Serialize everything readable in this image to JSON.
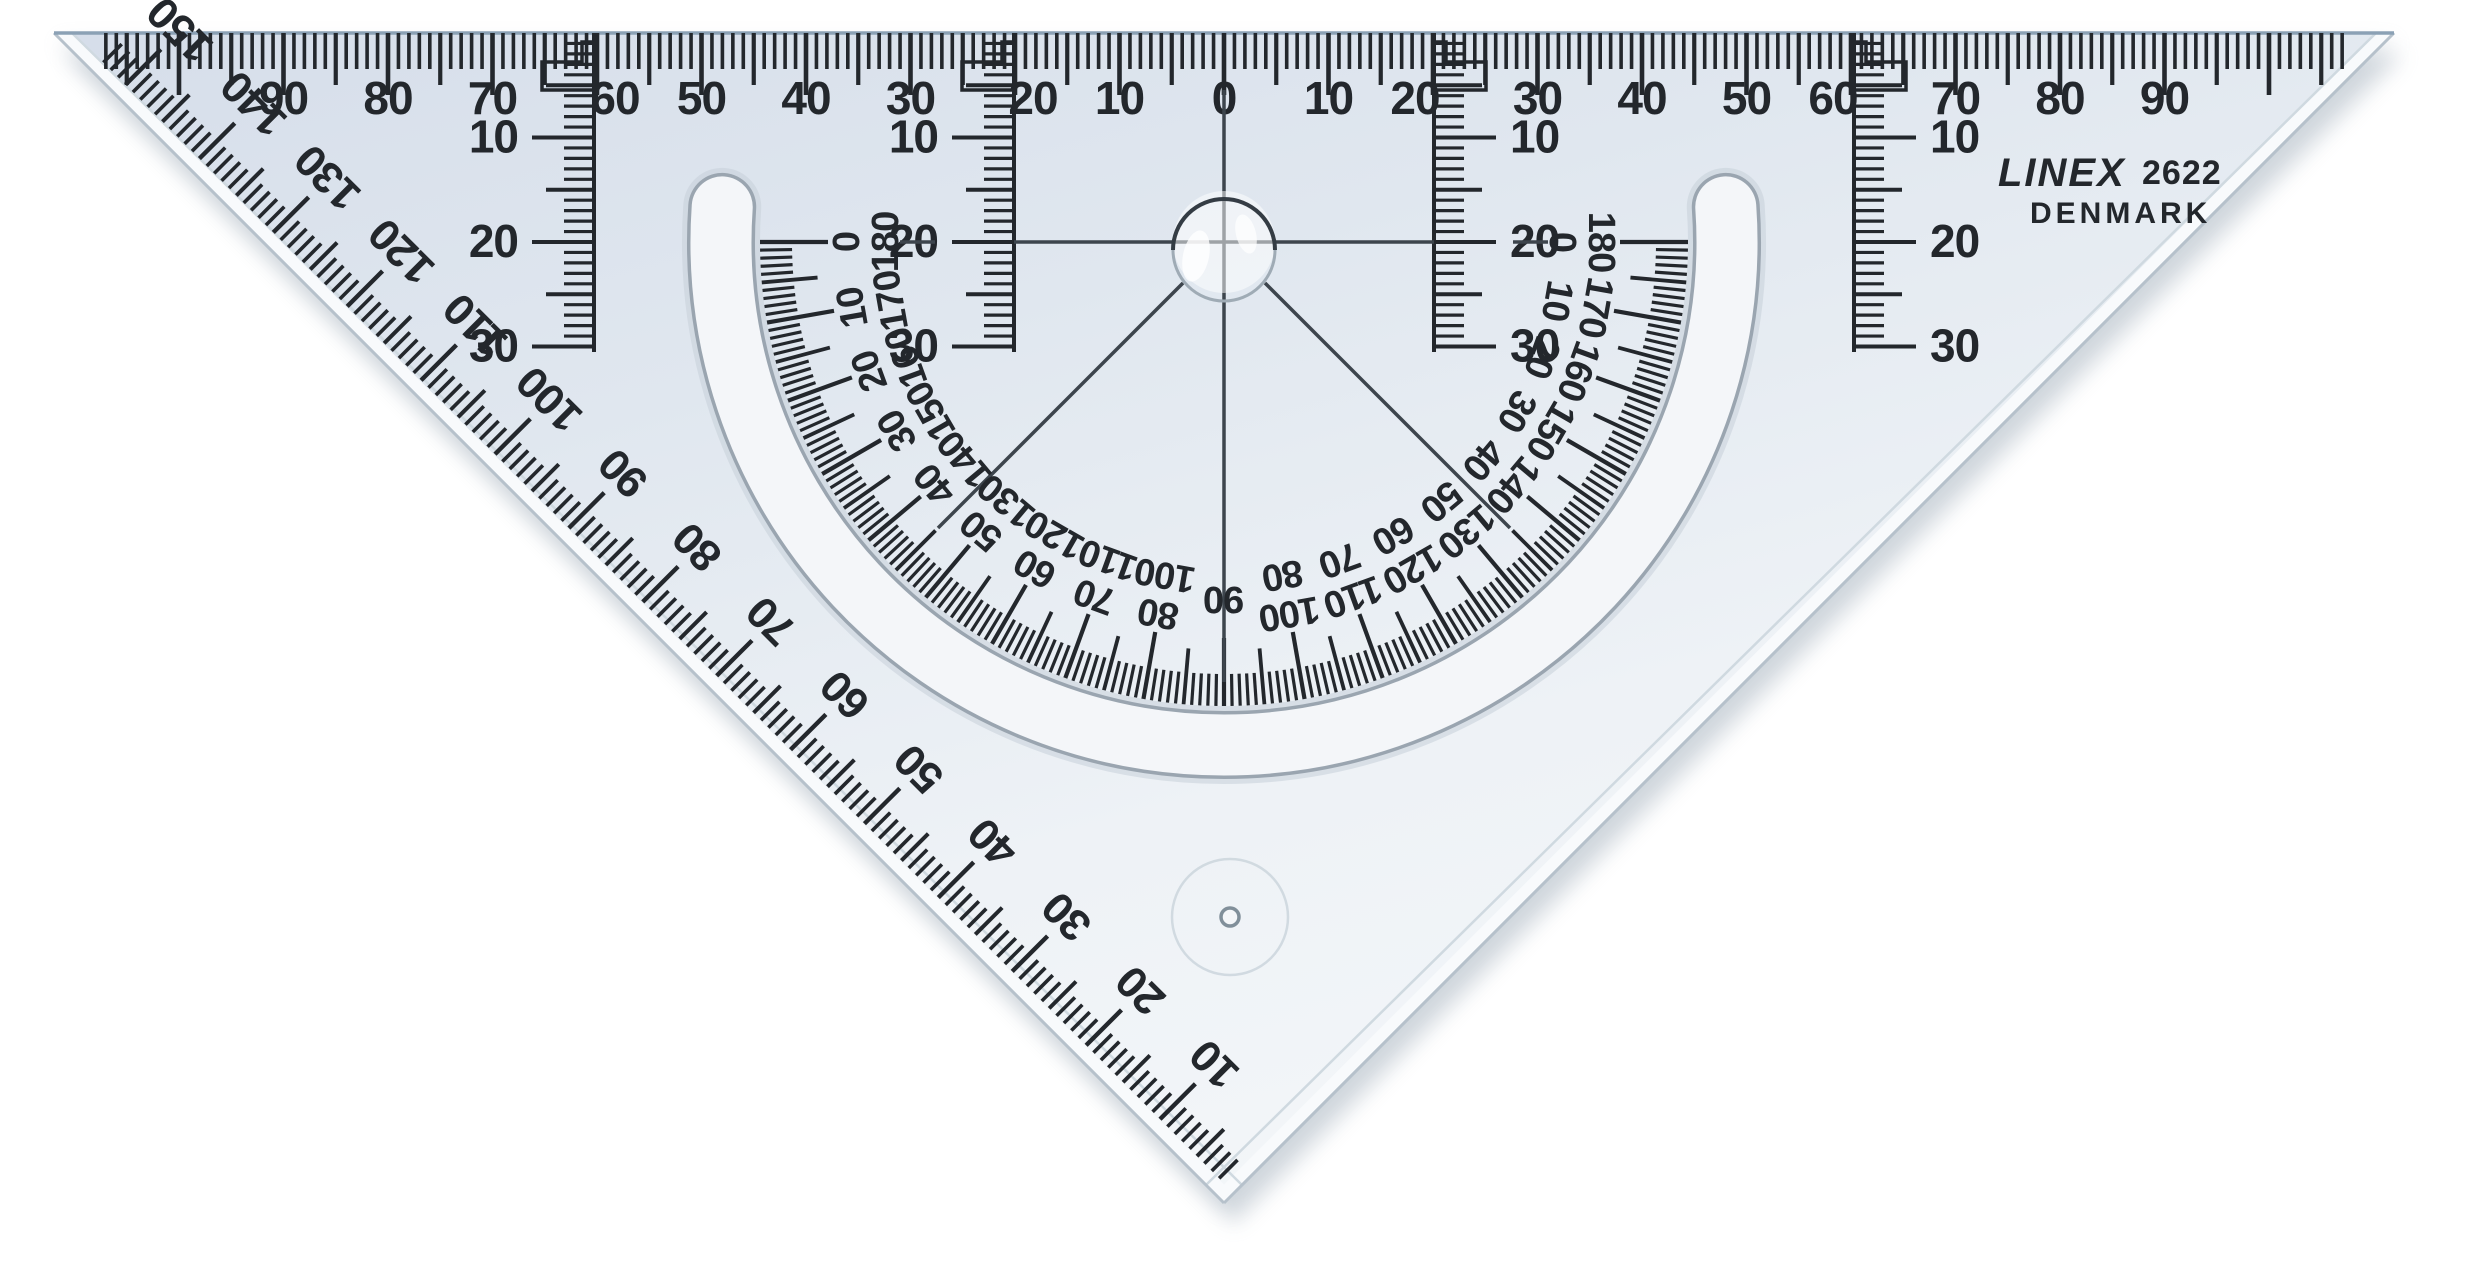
{
  "brand": {
    "name": "LINEX",
    "model": "2622",
    "country": "DENMARK"
  },
  "hypotenuse_ruler": {
    "center_label": "0",
    "side_labels": [
      "10",
      "20",
      "30",
      "40",
      "50",
      "60",
      "70",
      "80",
      "90"
    ]
  },
  "depth_scales": {
    "labels": [
      "10",
      "20",
      "30"
    ]
  },
  "edge_scale": {
    "labels": [
      "10",
      "20",
      "30",
      "40",
      "50",
      "60",
      "70",
      "80",
      "90",
      "100",
      "110",
      "120",
      "130",
      "140",
      "150"
    ]
  },
  "protractor": {
    "outer_labels": [
      "0",
      "10",
      "20",
      "30",
      "40",
      "50",
      "60",
      "70",
      "80",
      "90",
      "100",
      "110",
      "120",
      "130",
      "140",
      "150",
      "160",
      "170",
      "180"
    ],
    "inner_labels": [
      "180",
      "170",
      "160",
      "150",
      "140",
      "130",
      "120",
      "110",
      "100",
      "90",
      "80",
      "70",
      "60",
      "50",
      "40",
      "30",
      "20",
      "10",
      "0"
    ]
  },
  "colors": {
    "background": "#ffffff",
    "ink": "#23272c",
    "thin_line": "#3d454d",
    "body_top": "#d6deea",
    "body_mid": "#e0e7ef",
    "body_low": "#eef2f6",
    "body_bottom": "#f3f6f9",
    "bevel": "#f8fafc",
    "edge_line": "#b6c1cb",
    "inner_bevel_line": "#cfd9e0",
    "top_edge": "#8ba1b5",
    "slot_fill": "#f4f6f9",
    "slot_border": "#9aa5b0",
    "slot_soft": "#c7d0d8",
    "shadow": "#aeb9c4",
    "bubble_stroke_dark": "#343c44",
    "bubble_stroke_light": "#9fabb5",
    "faint_circle": "#c9d3db",
    "ejector_stroke": "#818f9a"
  }
}
